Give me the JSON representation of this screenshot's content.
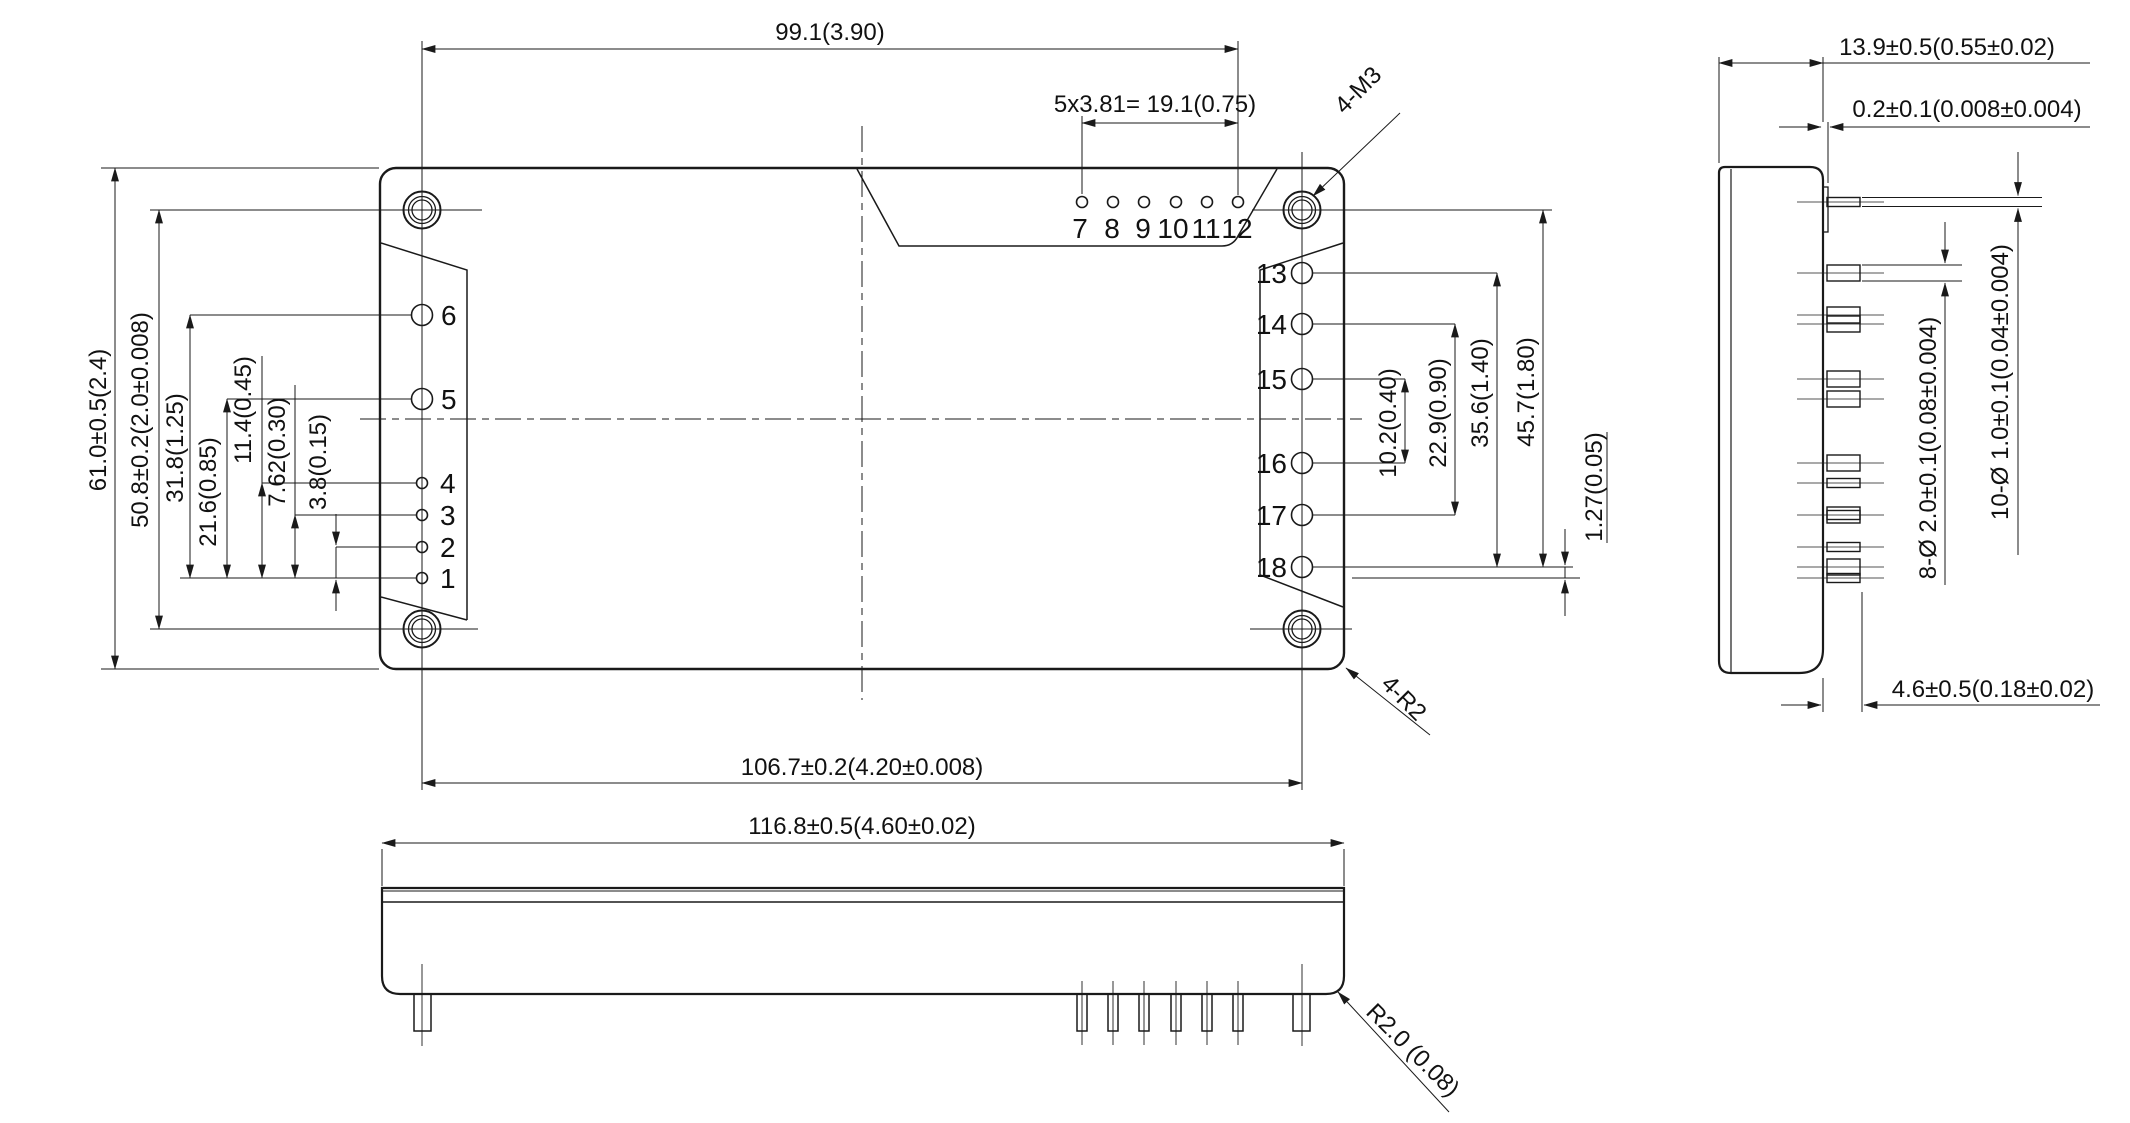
{
  "top_view": {
    "pin_labels_left": [
      "1",
      "2",
      "3",
      "4",
      "5",
      "6"
    ],
    "pin_labels_top": [
      "7",
      "8",
      "9",
      "10",
      "11",
      "12"
    ],
    "pin_labels_right": [
      "13",
      "14",
      "15",
      "16",
      "17",
      "18"
    ],
    "dims": {
      "hole_span_h": "99.1(3.90)",
      "pin_pitch": "5x3.81= 19.1(0.75)",
      "mounting_holes": "4-M3",
      "corner_radius": "4-R2",
      "body_height": "61.0±0.5(2.4)",
      "hole_span_v": "50.8±0.2(2.0±0.008)",
      "pin6_offset": "31.8(1.25)",
      "pin5_offset": "21.6(0.85)",
      "pin4_offset": "11.4(0.45)",
      "pin3_offset": "7.62(0.30)",
      "pin2_offset": "3.8(0.15)",
      "pin15_16_span": "10.2(0.40)",
      "pin14_17_span": "22.9(0.90)",
      "pin13_18_span": "35.6(1.40)",
      "hole_pin18_span": "45.7(1.80)",
      "pin18_edge_gap": "1.27(0.05)",
      "hole_span_bottom": "106.7±0.2(4.20±0.008)"
    }
  },
  "front_view": {
    "dims": {
      "body_width": "116.8±0.5(4.60±0.02)",
      "corner_radius": "R2.0 (0.08)"
    }
  },
  "side_view": {
    "dims": {
      "body_depth": "13.9±0.5(0.55±0.02)",
      "standoff": "0.2±0.1(0.008±0.004)",
      "small_pin_dia": "10-Ø 1.0±0.1(0.04±0.004)",
      "large_pin_dia": "8-Ø 2.0±0.1(0.08±0.004)",
      "pin_length": "4.6±0.5(0.18±0.02)"
    }
  },
  "colors": {
    "ink": "#1a1a1a",
    "paper": "#ffffff"
  }
}
